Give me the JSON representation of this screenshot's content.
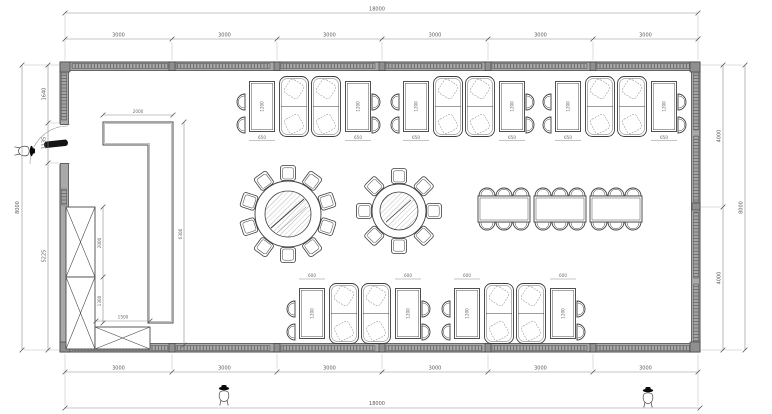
{
  "drawing": {
    "type": "restaurant-dining-room-floor-plan",
    "units": "mm"
  },
  "colors": {
    "line": "#3d3d3d",
    "dim": "#8a8a8a",
    "wall_fill": "#a9a9a9",
    "paper": "#ffffff",
    "door_leaf": "#141414"
  },
  "dims": {
    "top": {
      "overall": "18000",
      "segments": [
        "3000",
        "3000",
        "3000",
        "3000",
        "3000",
        "3000"
      ]
    },
    "bottom": {
      "overall": "18000",
      "segments": [
        "3000",
        "3000",
        "3000",
        "3000",
        "3000",
        "3000"
      ]
    },
    "left": {
      "overall": "8000",
      "segments": [
        "1640",
        "1135",
        "5225"
      ]
    },
    "right": {
      "overall": "8000",
      "segments": [
        "4000",
        "4000"
      ]
    }
  },
  "interior": {
    "counter_width": "2000",
    "counter_length": "6300",
    "cabinet_upper": "2000",
    "cabinet_lower": "1300",
    "cabinet_width": "1500",
    "top_table_length": "1200",
    "top_table_width": "650",
    "bottom_table_length": "1200",
    "bottom_table_width": "600"
  },
  "furniture": {
    "booth_groups_top": 3,
    "booth_groups_bottom": 2,
    "round_table_large_seats": 10,
    "round_table_small_seats": 8,
    "banquet_tables": 3,
    "banquet_seats": 18,
    "wall_cabinets": 3,
    "person_figures": 3
  }
}
